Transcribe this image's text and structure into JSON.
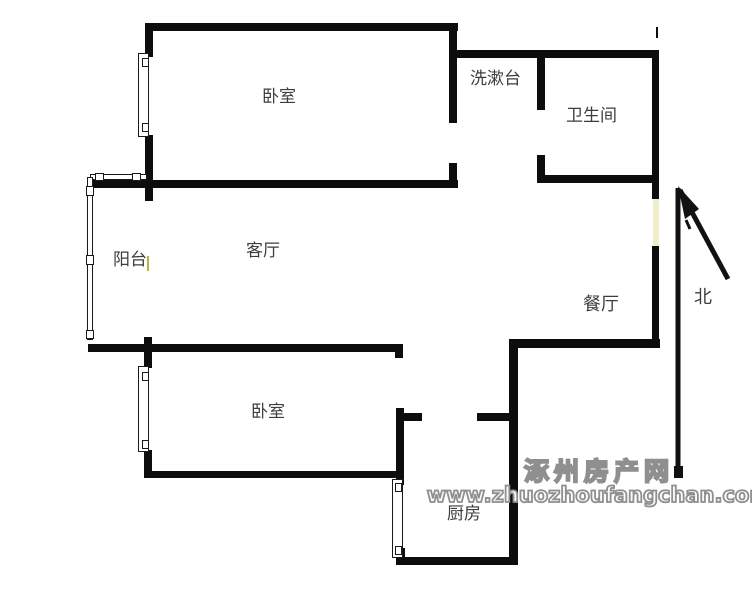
{
  "rooms": {
    "bedroom_top": "卧室",
    "washstand": "洗漱台",
    "bathroom": "卫生间",
    "balcony": "阳台",
    "living_room": "客厅",
    "dining_room": "餐厅",
    "bedroom_bottom": "卧室",
    "kitchen": "厨房"
  },
  "compass": {
    "north": "北"
  },
  "watermark": {
    "site_name": "涿州房产网",
    "site_url": "www.zhuozhoufangchan.com"
  },
  "colors": {
    "wall": "#0d0d0d",
    "line": "#1a1a1a",
    "door_gap": "#efedcb",
    "text": "#3d3d3d",
    "watermark": "#8f8f8f",
    "balcony_mark": "#b9b441",
    "background": "#ffffff"
  }
}
